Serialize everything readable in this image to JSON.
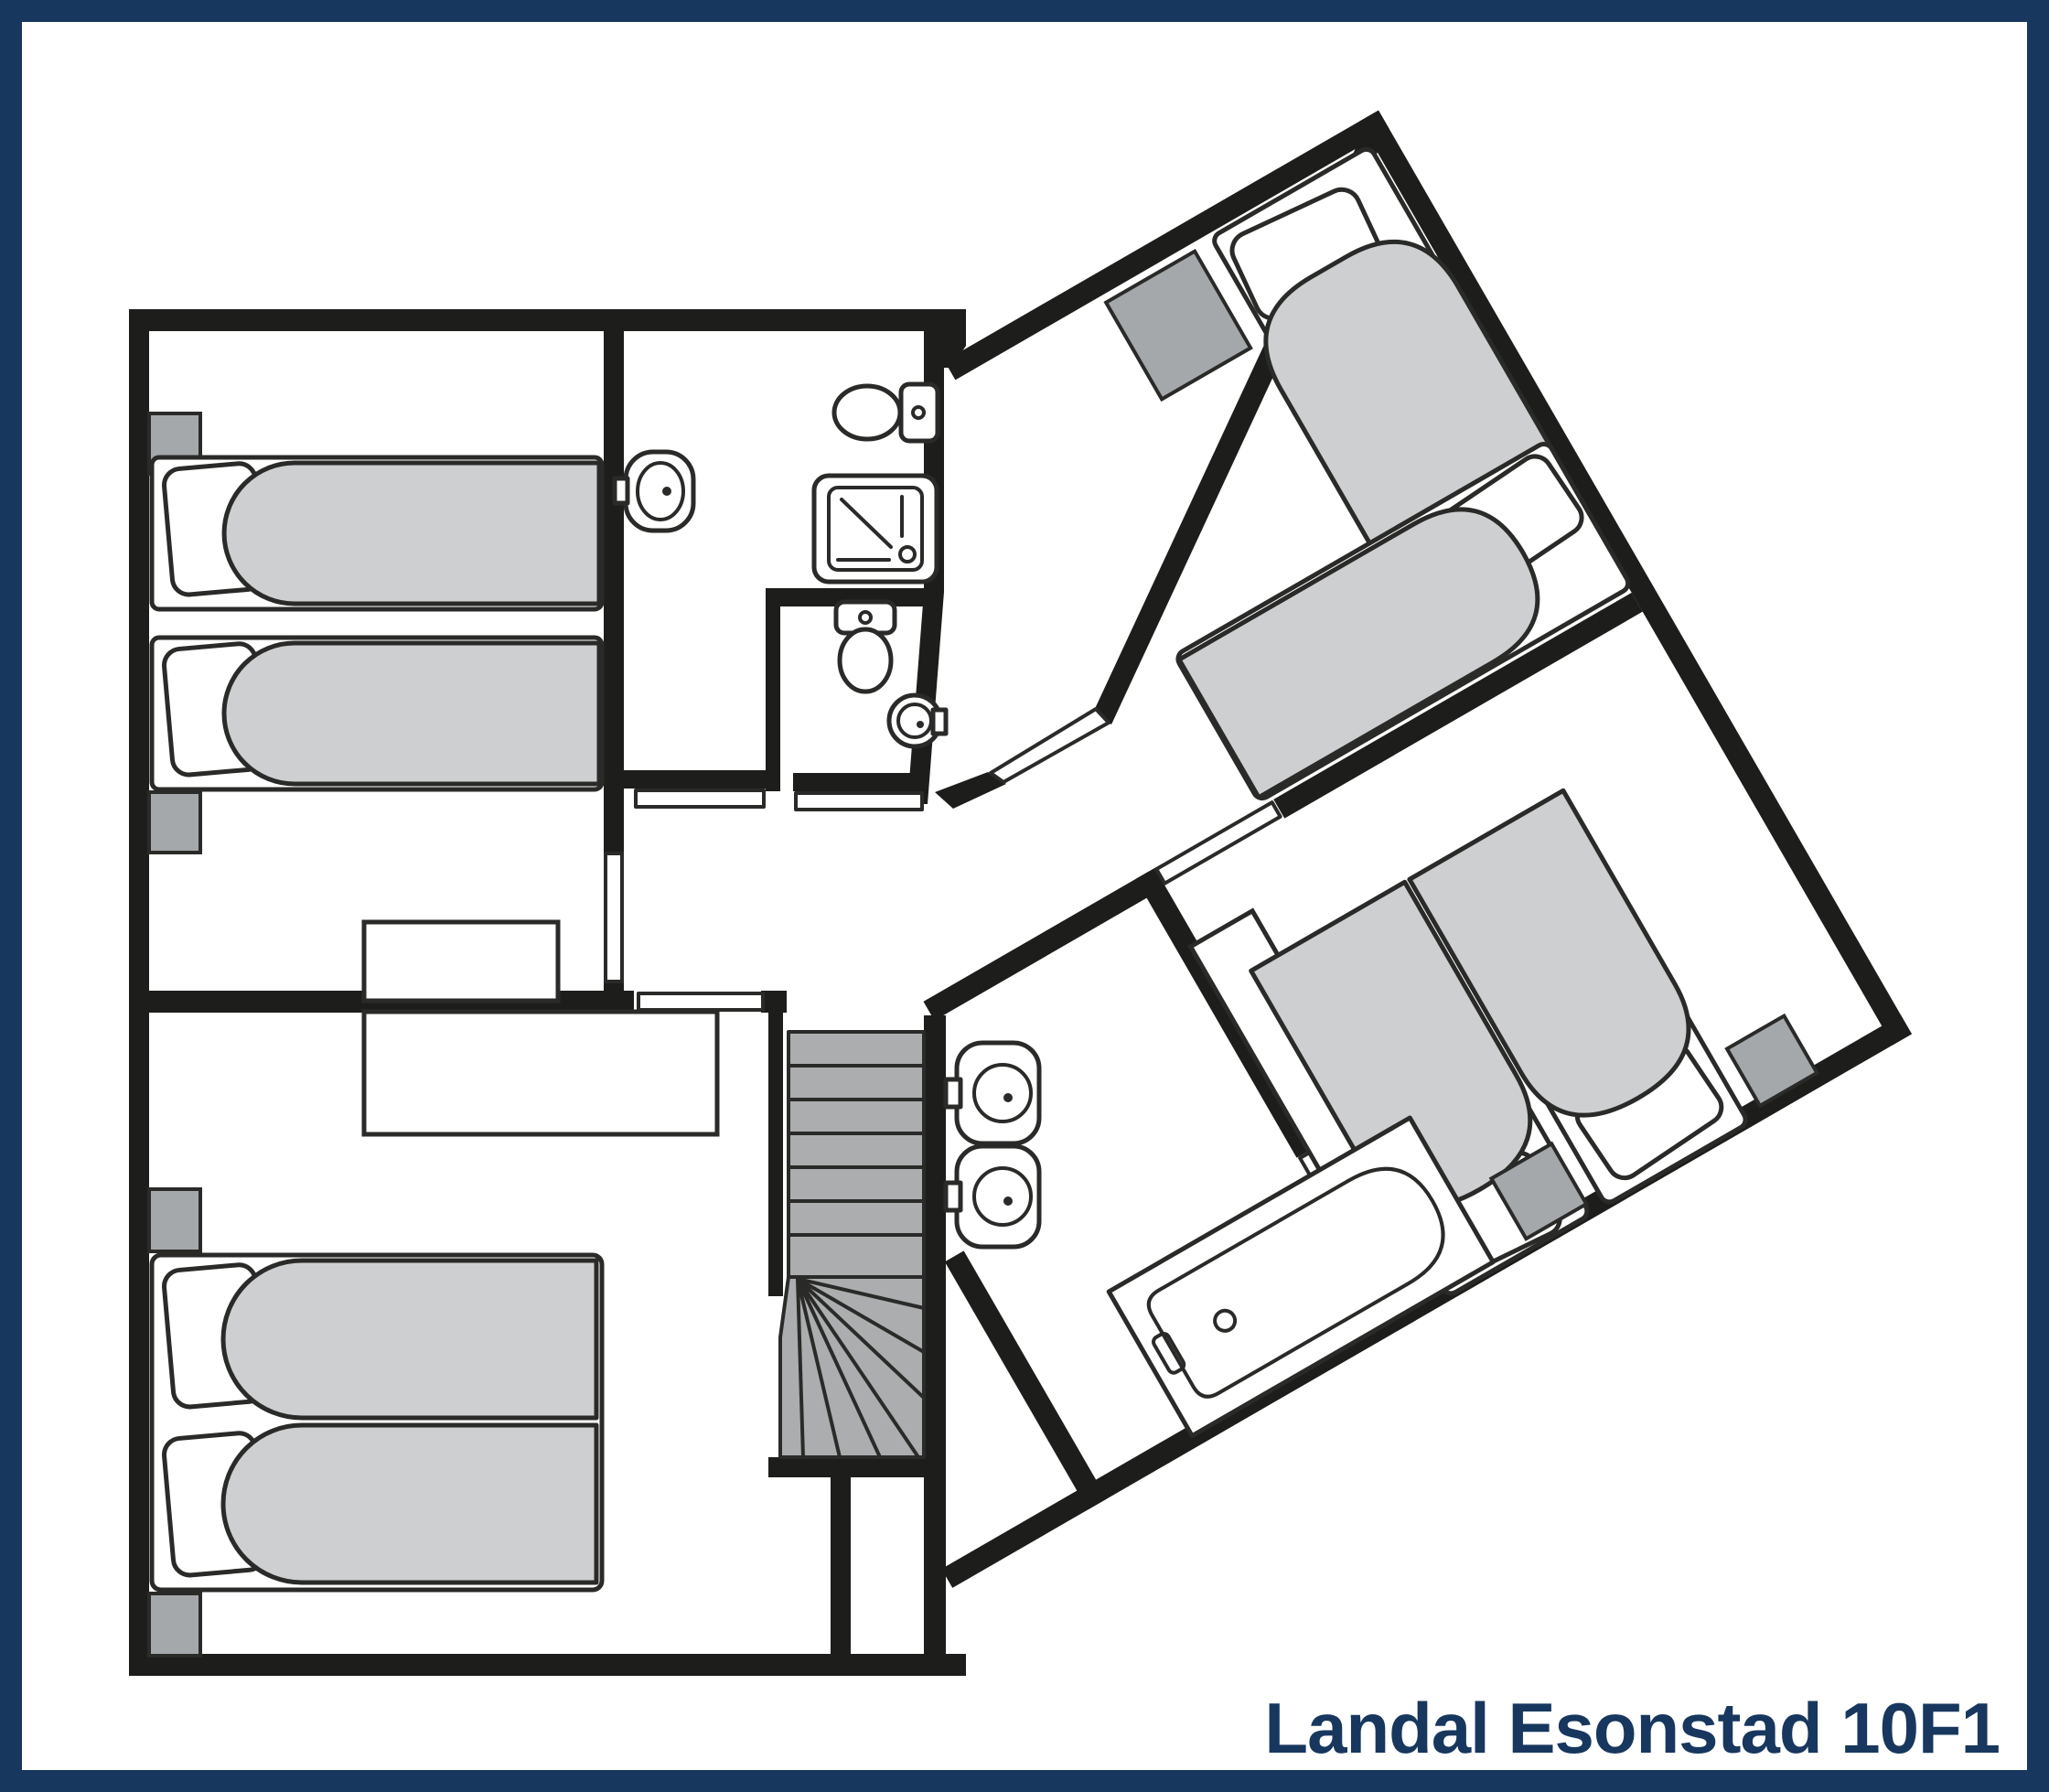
{
  "title": {
    "text": "Landal Esonstad 10F1"
  },
  "colors": {
    "background": "#ffffff",
    "border_navy": "#17375e",
    "title_navy": "#17375e",
    "wall_black": "#1d1d1b",
    "outline": "#2a2a28",
    "furniture_gray": "#cdcfd1",
    "furniture_gray_dark": "#a5a8ab",
    "stairs_gray": "#abadaf"
  },
  "floor_plan": {
    "floor_label": "10F1",
    "rotated_wing_angle_deg": -30,
    "rooms": [
      {
        "name": "bedroom-top-left",
        "beds": 2,
        "nightstands": 2,
        "cabinets": 1
      },
      {
        "name": "bedroom-bottom-left",
        "beds": 2,
        "nightstands": 2,
        "desks": 1
      },
      {
        "name": "bathroom-left",
        "washbasins": 1,
        "toilets": 1,
        "showers": 1
      },
      {
        "name": "wc",
        "toilets": 1,
        "washbasins": 1
      },
      {
        "name": "landing-hall",
        "staircases": 1
      },
      {
        "name": "bedroom-top-right",
        "beds": 2,
        "nightstands": 1
      },
      {
        "name": "bedroom-middle-right",
        "beds": 2,
        "nightstands": 2,
        "desks": 1
      },
      {
        "name": "bathroom-right",
        "washbasins": 2,
        "bathtubs": 1
      }
    ]
  }
}
